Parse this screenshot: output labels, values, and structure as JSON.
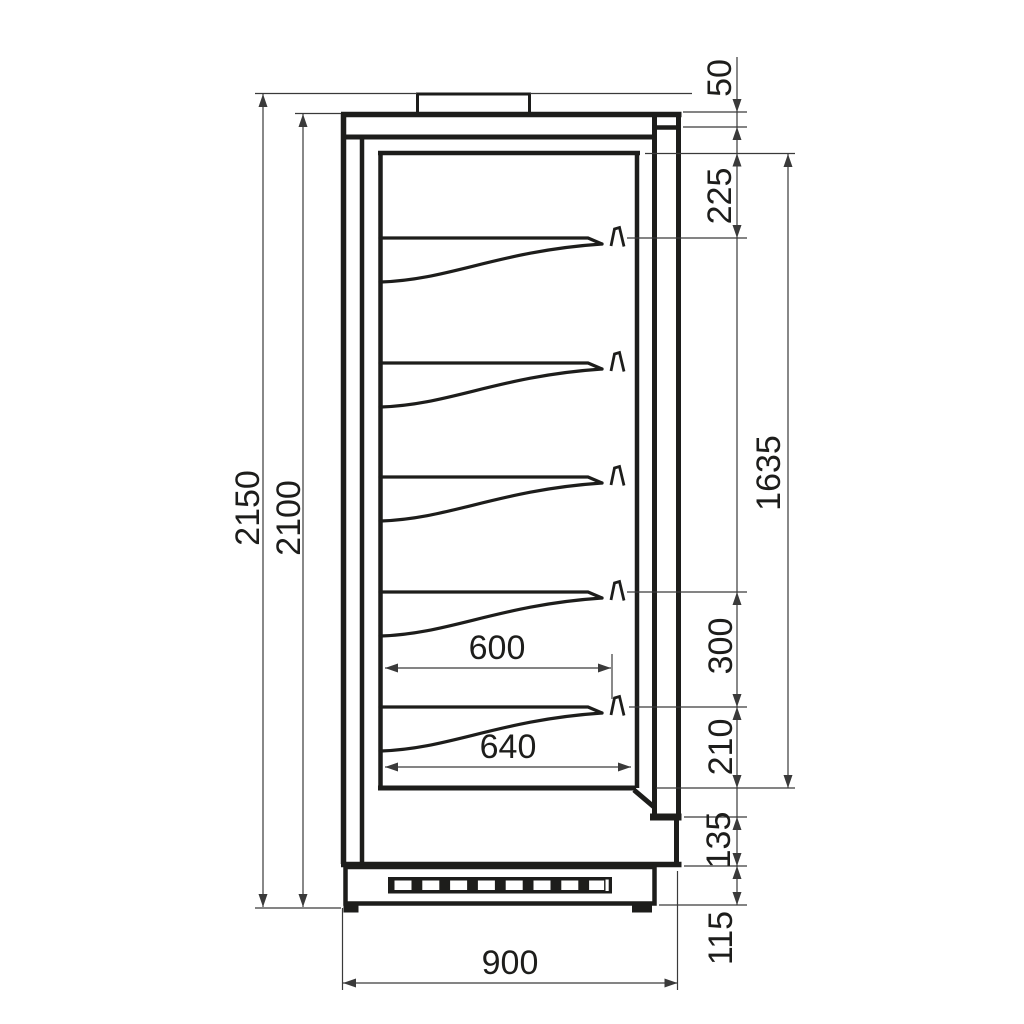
{
  "drawing": {
    "kind": "technical-dimension-drawing",
    "view": "side-section",
    "units": "mm",
    "colors": {
      "ink": "#1d1d1b",
      "dim": "#3a3a3a",
      "background": "#ffffff"
    },
    "dimensions": {
      "overall_height": "2150",
      "cabinet_height": "2100",
      "canopy_front": "50",
      "top_to_first_shelf": "225",
      "interior_height": "1635",
      "shelf_spacing": "300",
      "bottom_shelf_clearance": "210",
      "base_front_height": "135",
      "plinth_height": "115",
      "shelf_depth": "600",
      "bottom_shelf_depth": "640",
      "overall_depth": "900"
    }
  }
}
